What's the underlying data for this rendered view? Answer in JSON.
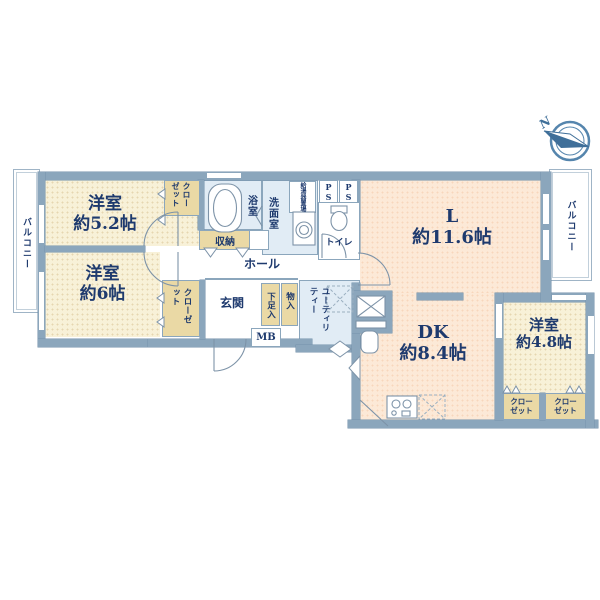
{
  "compass": {
    "north_label": "N"
  },
  "labels": {
    "balcony_left": "バルコニー",
    "balcony_right": "バルコニー",
    "room_52": {
      "line1": "洋室",
      "line2": "約5.2帖"
    },
    "room_6": {
      "line1": "洋室",
      "line2": "約6帖"
    },
    "room_48": {
      "line1": "洋室",
      "line2": "約4.8帖"
    },
    "living": {
      "line1": "L",
      "line2": "約11.6帖"
    },
    "dining_kitchen": {
      "line1": "DK",
      "line2": "約8.4帖"
    },
    "closet_52": "クローゼット",
    "closet_6": "クローゼット",
    "closet_48_left": {
      "line1": "クロー",
      "line2": "ゼット"
    },
    "closet_48_right": {
      "line1": "クロー",
      "line2": "ゼット"
    },
    "bath": "浴室",
    "washroom": "洗面室",
    "water_heater": "給湯器置場",
    "pipe_space_1": "PS",
    "pipe_space_2": "PS",
    "toilet": "トイレ",
    "storage": "収納",
    "hall": "ホール",
    "entrance": "玄関",
    "shoe_cabinet": "下足入",
    "storage_small": "物入",
    "meter_box": "MB",
    "utility": "ユーティリティー"
  },
  "colors": {
    "wall": "#8ba6bc",
    "western_room_fill": "#f8f1d8",
    "ldk_fill": "#fce9d7",
    "wet_area_fill": "#e1ecf5",
    "closet_fill": "#ead9a5",
    "text": "#1e3a6e",
    "compass": "#3f6f99"
  }
}
